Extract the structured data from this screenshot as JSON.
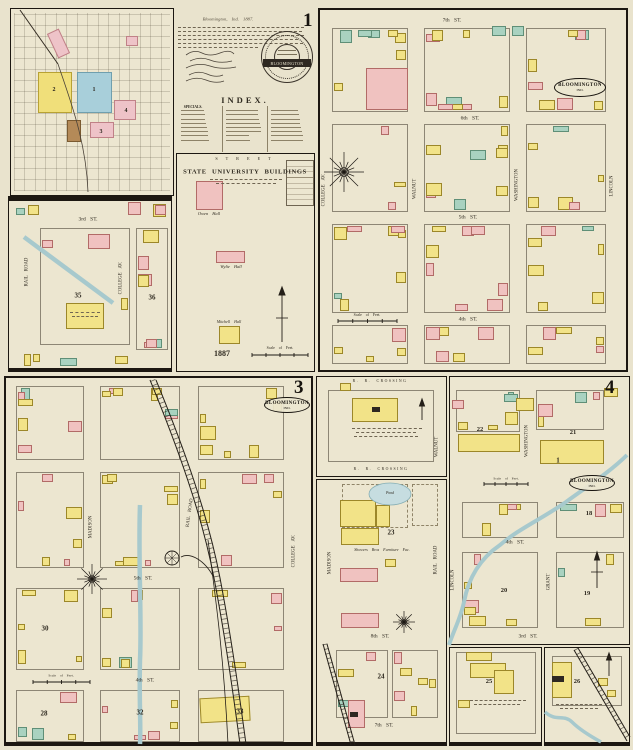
{
  "canvas": {
    "w": 633,
    "h": 750,
    "bg": "#e9e3cd"
  },
  "palette": {
    "building_yellow": "#f2e388",
    "building_pink": "#f0c2c0",
    "building_teal": "#a9d2c0",
    "building_brown": "#b48a58",
    "water": "#a7c9cd",
    "district_blue": "#a8cfda",
    "ink": "#2f2a20"
  },
  "notes": {
    "dateline": "Bloomington, Ind. 1887.",
    "index_title": "INDEX.",
    "specials_label": "SPECIALS.",
    "seal_text": "BLOOMINGTON",
    "page_number": "1"
  },
  "index_map": {
    "labels": [
      {
        "n": "index-sheet2-number",
        "t": "2",
        "x": 54,
        "y": 90,
        "s": 6,
        "b": 1
      },
      {
        "n": "index-sheet1-number",
        "t": "1",
        "x": 94,
        "y": 90,
        "s": 6,
        "b": 1
      },
      {
        "n": "index-sheet3-number",
        "t": "3",
        "x": 101,
        "y": 132,
        "s": 6,
        "b": 1
      },
      {
        "n": "index-sheet4-number",
        "t": "4",
        "x": 126,
        "y": 111,
        "s": 6,
        "b": 1
      }
    ]
  },
  "university": {
    "labels": [
      {
        "n": "street-label-top",
        "t": "S T R E E T",
        "x": 244,
        "y": 159,
        "s": 4.2,
        "ls": 2
      },
      {
        "n": "university-title",
        "t": "STATE UNIVERSITY BUILDINGS",
        "x": 245,
        "y": 173,
        "s": 6.6,
        "b": 1,
        "ls": 0.6
      },
      {
        "n": "owen-hall-label",
        "t": "Owen Hall",
        "x": 209,
        "y": 214,
        "s": 4.4,
        "i": 1
      },
      {
        "n": "wylie-hall-label",
        "t": "Wylie Hall",
        "x": 231,
        "y": 267,
        "s": 4.4,
        "i": 1
      },
      {
        "n": "mitchell-hall-label",
        "t": "Mitchell Hall",
        "x": 229,
        "y": 322,
        "s": 4,
        "i": 1
      },
      {
        "n": "year-label",
        "t": "1887",
        "x": 222,
        "y": 354,
        "s": 8,
        "b": 1
      },
      {
        "n": "scale-label",
        "t": "Scale of Feet.",
        "x": 280,
        "y": 349,
        "s": 3.8
      }
    ]
  },
  "sheet2": {
    "labels": [
      {
        "n": "street-3rd-st",
        "t": "3rd  ST.",
        "x": 88,
        "y": 220,
        "s": 5.5
      },
      {
        "n": "street-rail-road",
        "t": "RAIL ROAD",
        "x": 28,
        "y": 272,
        "s": 4.8,
        "r": -90
      },
      {
        "n": "street-college-av",
        "t": "COLLEGE  AV.",
        "x": 122,
        "y": 278,
        "s": 4.8,
        "r": -90
      },
      {
        "n": "block-number-35",
        "t": "35",
        "x": 78,
        "y": 296,
        "s": 7,
        "b": 1
      },
      {
        "n": "block-number-36",
        "t": "36",
        "x": 152,
        "y": 298,
        "s": 7,
        "b": 1
      }
    ]
  },
  "sheet1": {
    "number": "1",
    "stamp": {
      "text": "BLOOMINGTON",
      "sub": "IND."
    },
    "labels": [
      {
        "n": "street-7th-st",
        "t": "7th  ST.",
        "x": 452,
        "y": 21,
        "s": 5.5
      },
      {
        "n": "street-6th-st",
        "t": "6th  ST.",
        "x": 470,
        "y": 119,
        "s": 5.5
      },
      {
        "n": "street-5th-st",
        "t": "5th  ST.",
        "x": 468,
        "y": 218,
        "s": 5.5
      },
      {
        "n": "street-4th-st",
        "t": "4th  ST.",
        "x": 468,
        "y": 320,
        "s": 5.5
      },
      {
        "n": "street-college-av",
        "t": "COLLEGE  AV.",
        "x": 325,
        "y": 190,
        "s": 4.8,
        "r": -90
      },
      {
        "n": "street-walnut",
        "t": "WALNUT",
        "x": 416,
        "y": 189,
        "s": 4.8,
        "r": -90
      },
      {
        "n": "street-washington",
        "t": "WASHINGTON",
        "x": 518,
        "y": 185,
        "s": 4.8,
        "r": -90
      },
      {
        "n": "street-lincoln",
        "t": "LINCOLN",
        "x": 613,
        "y": 186,
        "s": 4.8,
        "r": -90
      },
      {
        "n": "scale-label",
        "t": "Scale of Feet.",
        "x": 367,
        "y": 316,
        "s": 3.8
      }
    ]
  },
  "sheet3": {
    "number": "3",
    "stamp": {
      "text": "BLOOMINGTON",
      "sub": "IND."
    },
    "labels": [
      {
        "n": "street-madison",
        "t": "MADISON",
        "x": 92,
        "y": 527,
        "s": 4.8,
        "r": -90
      },
      {
        "n": "street-rail-road",
        "t": "RAIL ROAD",
        "x": 191,
        "y": 513,
        "s": 4.8,
        "r": -82
      },
      {
        "n": "street-college-av",
        "t": "COLLEGE  AV.",
        "x": 295,
        "y": 551,
        "s": 4.8,
        "r": -90
      },
      {
        "n": "street-5th-st",
        "t": "5th  ST.",
        "x": 143,
        "y": 579,
        "s": 5.5
      },
      {
        "n": "street-4th-st",
        "t": "4th  ST.",
        "x": 145,
        "y": 681,
        "s": 5.5
      },
      {
        "n": "block-number-30",
        "t": "30",
        "x": 45,
        "y": 629,
        "s": 7,
        "b": 1
      },
      {
        "n": "block-number-28",
        "t": "28",
        "x": 44,
        "y": 714,
        "s": 7,
        "b": 1
      },
      {
        "n": "block-number-32",
        "t": "32",
        "x": 140,
        "y": 713,
        "s": 7,
        "b": 1
      },
      {
        "n": "block-number-33",
        "t": "33",
        "x": 240,
        "y": 712,
        "s": 7,
        "b": 1
      },
      {
        "n": "scale-label",
        "t": "Scale of Feet.",
        "x": 61,
        "y": 676,
        "s": 3.5
      }
    ]
  },
  "middle": {
    "labels": [
      {
        "n": "rr-crossing-top",
        "t": "R. R.  CROSSING",
        "x": 380,
        "y": 382,
        "s": 3.8,
        "ls": 1.5
      },
      {
        "n": "rr-crossing-bottom",
        "t": "R. R.  CROSSING",
        "x": 381,
        "y": 470,
        "s": 3.8,
        "ls": 1.5
      },
      {
        "n": "street-walnut",
        "t": "WALNUT",
        "x": 438,
        "y": 447,
        "s": 4.8,
        "r": -90
      },
      {
        "n": "street-madison",
        "t": "MADISON",
        "x": 331,
        "y": 563,
        "s": 4.8,
        "r": -90
      },
      {
        "n": "street-rail-road",
        "t": "RAIL ROAD",
        "x": 437,
        "y": 560,
        "s": 4.8,
        "r": -90
      },
      {
        "n": "pond-label",
        "t": "Pond",
        "x": 390,
        "y": 494,
        "s": 3.8,
        "i": 1
      },
      {
        "n": "block-number-23",
        "t": "23",
        "x": 391,
        "y": 533,
        "s": 7,
        "b": 1
      },
      {
        "n": "showers-factory-label",
        "t": "Showers Bros Furniture Fac.",
        "x": 382,
        "y": 550,
        "s": 4,
        "i": 1
      },
      {
        "n": "street-8th-st",
        "t": "8th  ST.",
        "x": 380,
        "y": 637,
        "s": 5.5
      },
      {
        "n": "block-number-24",
        "t": "24",
        "x": 381,
        "y": 677,
        "s": 7,
        "b": 1
      },
      {
        "n": "street-7th-st",
        "t": "7th  ST.",
        "x": 384,
        "y": 726,
        "s": 5.5
      }
    ]
  },
  "sheet4": {
    "number": "4",
    "stamp": {
      "text": "BLOOMINGTON",
      "sub": "IND."
    },
    "labels": [
      {
        "n": "street-washington",
        "t": "WASHINGTON",
        "x": 528,
        "y": 441,
        "s": 4.8,
        "r": -90
      },
      {
        "n": "street-lincoln",
        "t": "LINCOLN",
        "x": 454,
        "y": 580,
        "s": 4.8,
        "r": -90
      },
      {
        "n": "street-grant",
        "t": "GRANT",
        "x": 550,
        "y": 582,
        "s": 4.8,
        "r": -90
      },
      {
        "n": "street-4th-st",
        "t": "4th  ST.",
        "x": 515,
        "y": 543,
        "s": 5.5
      },
      {
        "n": "street-3rd-st",
        "t": "3rd  ST.",
        "x": 528,
        "y": 637,
        "s": 5.5
      },
      {
        "n": "block-number-22",
        "t": "22",
        "x": 480,
        "y": 430,
        "s": 6.5,
        "b": 1
      },
      {
        "n": "block-number-21",
        "t": "21",
        "x": 573,
        "y": 433,
        "s": 6.5,
        "b": 1
      },
      {
        "n": "block-number-1",
        "t": "1",
        "x": 558,
        "y": 461,
        "s": 7,
        "b": 1
      },
      {
        "n": "block-number-18",
        "t": "18",
        "x": 589,
        "y": 514,
        "s": 6.5,
        "b": 1
      },
      {
        "n": "block-number-20",
        "t": "20",
        "x": 504,
        "y": 591,
        "s": 6.5,
        "b": 1
      },
      {
        "n": "block-number-19",
        "t": "19",
        "x": 587,
        "y": 594,
        "s": 6.5,
        "b": 1
      },
      {
        "n": "block-number-25",
        "t": "25",
        "x": 489,
        "y": 682,
        "s": 6.5,
        "b": 1
      },
      {
        "n": "block-number-26",
        "t": "26",
        "x": 577,
        "y": 682,
        "s": 6.5,
        "b": 1
      },
      {
        "n": "scale-label",
        "t": "Scale of Feet.",
        "x": 506,
        "y": 479,
        "s": 3.5
      }
    ]
  }
}
